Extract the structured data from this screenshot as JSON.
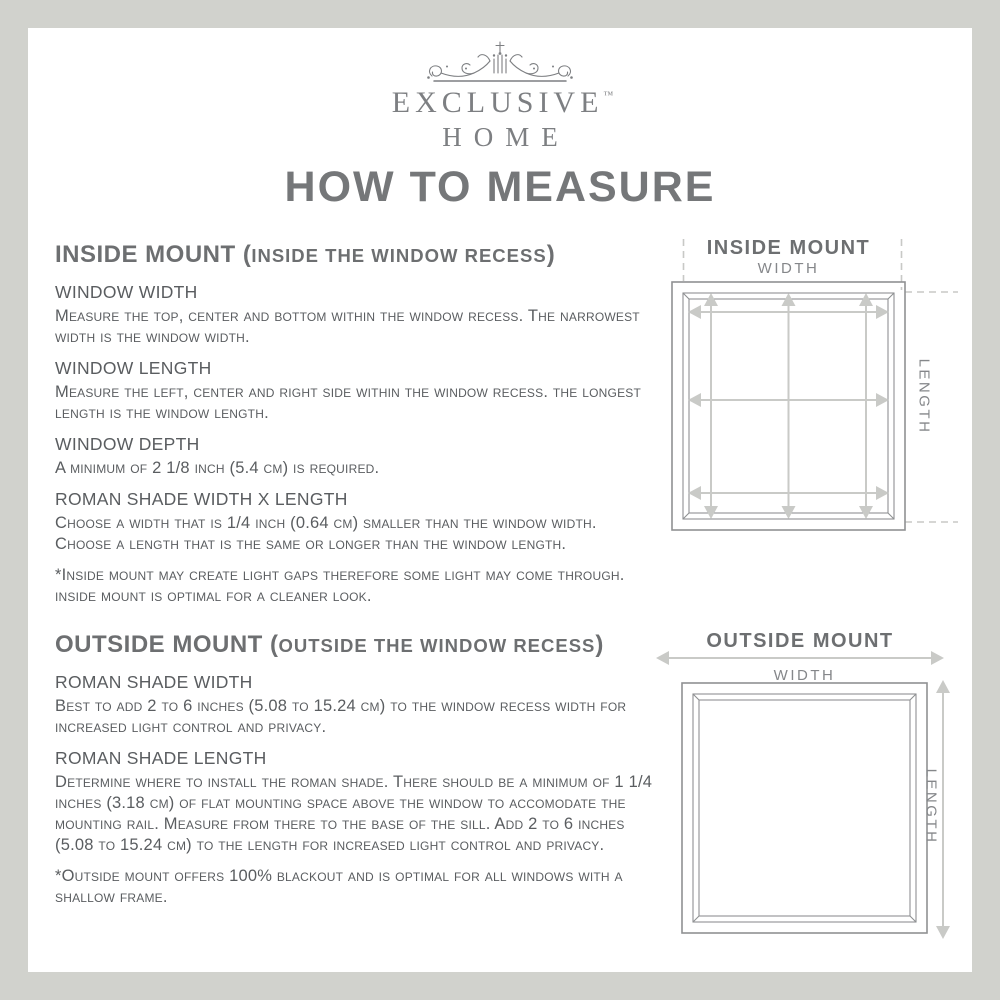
{
  "brand": {
    "name": "EXCLUSIVE",
    "trademark": "™",
    "name2": "HOME"
  },
  "page_title": "HOW TO MEASURE",
  "sections": {
    "inside": {
      "heading_main": "INSIDE MOUNT (",
      "heading_paren": "INSIDE THE WINDOW RECESS",
      "heading_close": ")",
      "items": [
        {
          "label": "WINDOW WIDTH",
          "body": "Measure the top, center and bottom within the window recess. The narrowest width is the window width."
        },
        {
          "label": "WINDOW LENGTH",
          "body": "Measure the left, center and right side within the window recess. the longest length is the window length."
        },
        {
          "label": "WINDOW DEPTH",
          "body": "A minimum of 2 1/8 inch (5.4 cm) is required."
        },
        {
          "label": "ROMAN SHADE WIDTH X LENGTH",
          "body": "Choose a width that is 1/4 inch (0.64 cm) smaller than the window width. Choose a length that is the same or longer than the window length."
        }
      ],
      "note": "*Inside mount may create light gaps therefore some light may come through. inside mount is optimal for a cleaner look."
    },
    "outside": {
      "heading_main": "OUTSIDE MOUNT (",
      "heading_paren": "OUTSIDE THE WINDOW RECESS",
      "heading_close": ")",
      "items": [
        {
          "label": "ROMAN SHADE WIDTH",
          "body": "Best to add 2 to 6 inches (5.08 to 15.24 cm) to the window recess width for increased light control and privacy."
        },
        {
          "label": "ROMAN SHADE LENGTH",
          "body": "Determine where to install the roman shade. There should be a minimum of 1 1/4 inches (3.18 cm) of flat mounting space above the window to accomodate the mounting rail. Measure from there to the base of the sill. Add 2 to 6 inches (5.08 to 15.24 cm) to the length for increased light control and privacy."
        }
      ],
      "note": "*Outside mount offers 100% blackout and is optimal for all windows with a shallow frame."
    }
  },
  "diagrams": {
    "inside": {
      "title": "INSIDE MOUNT",
      "width_label": "WIDTH",
      "length_label": "LENGTH"
    },
    "outside": {
      "title": "OUTSIDE MOUNT",
      "width_label": "WIDTH",
      "length_label": "LENGTH"
    }
  },
  "colors": {
    "page_border": "#d1d2cd",
    "sheet": "#ffffff",
    "brand": "#7d7f82",
    "title": "#757779",
    "heading": "#6d6f71",
    "body": "#5a5d60",
    "label": "#85878a",
    "line": "#8f9193",
    "arrow": "#c9cac7",
    "dash": "#c8c9c6"
  }
}
